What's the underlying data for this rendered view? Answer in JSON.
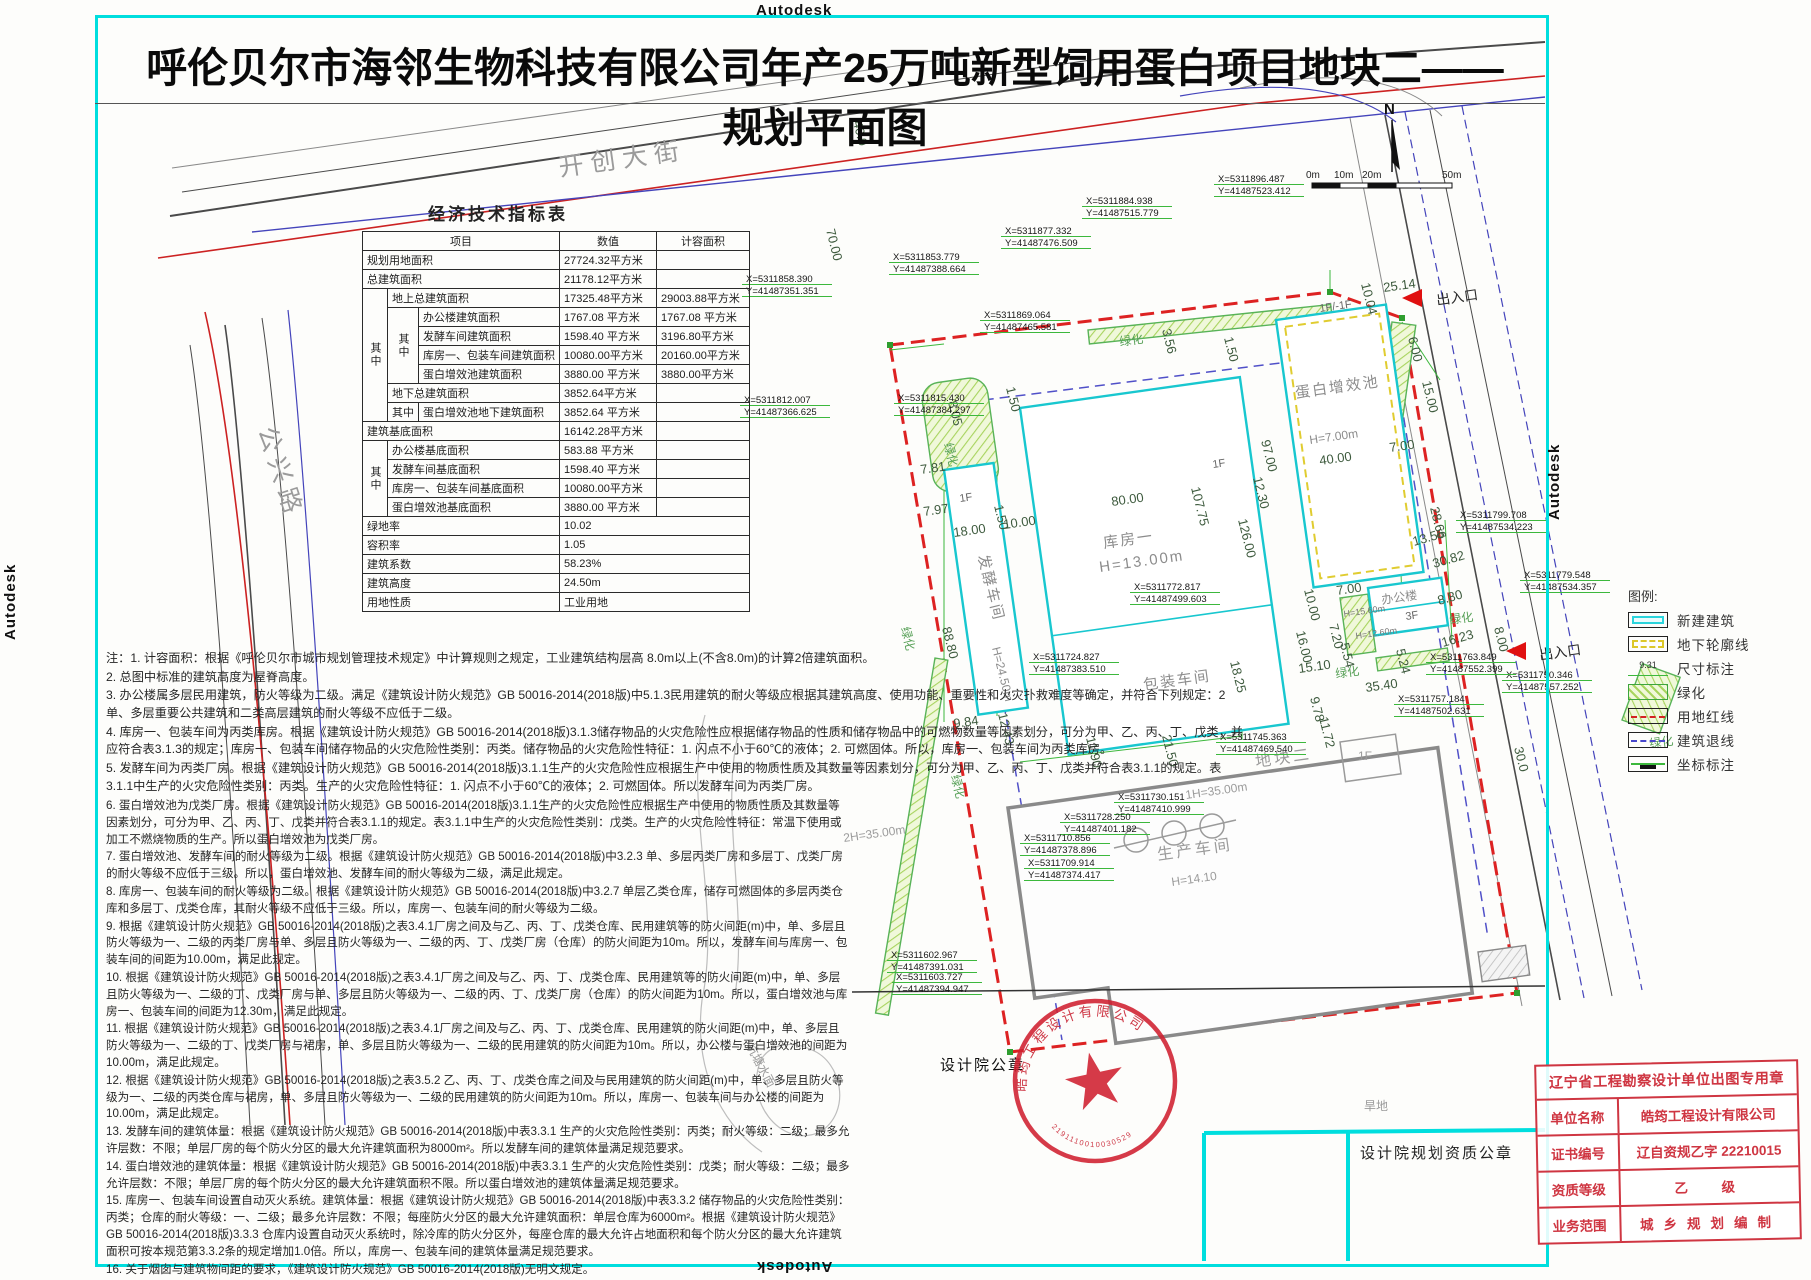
{
  "watermark": "Autodesk",
  "title": "呼伦贝尔市海邻生物科技有限公司年产25万吨新型饲用蛋白项目地块二——规划平面图",
  "table": {
    "title": "经济技术指标表",
    "col_item": "项目",
    "col_value": "数值",
    "col_capacity": "计容面积",
    "zhong": "其中",
    "rows": {
      "ra": {
        "l": "规划用地面积",
        "v": "27724.32平方米"
      },
      "rb": {
        "l": "总建筑面积",
        "v": "21178.12平方米"
      },
      "rc": {
        "l": "地上总建筑面积",
        "v": "17325.48平方米",
        "c": "29003.88平方米"
      },
      "rd": {
        "l": "办公楼建筑面积",
        "v": "1767.08 平方米",
        "c": "1767.08 平方米"
      },
      "re": {
        "l": "发酵车间建筑面积",
        "v": "1598.40 平方米",
        "c": "3196.80平方米"
      },
      "rf": {
        "l": "库房一、包装车间建筑面积",
        "v": "10080.00平方米",
        "c": "20160.00平方米"
      },
      "rg": {
        "l": "蛋白增效池建筑面积",
        "v": "3880.00 平方米",
        "c": "3880.00平方米"
      },
      "rh": {
        "l": "地下总建筑面积",
        "v": "3852.64平方米"
      },
      "ri": {
        "l": "蛋白增效池地下建筑面积",
        "v": "3852.64 平方米"
      },
      "rj": {
        "l": "建筑基底面积",
        "v": "16142.28平方米"
      },
      "rk": {
        "l": "办公楼基底面积",
        "v": "583.88  平方米"
      },
      "rl": {
        "l": "发酵车间基底面积",
        "v": "1598.40 平方米"
      },
      "rm": {
        "l": "库房一、包装车间基底面积",
        "v": "10080.00平方米"
      },
      "rn": {
        "l": "蛋白增效池基底面积",
        "v": "3880.00 平方米"
      },
      "ro": {
        "l": "绿地率",
        "v": "10.02"
      },
      "rp": {
        "l": "容积率",
        "v": "1.05"
      },
      "rq": {
        "l": "建筑系数",
        "v": "58.23%"
      },
      "rr": {
        "l": "建筑高度",
        "v": "24.50m"
      },
      "rs": {
        "l": "用地性质",
        "v": "工业用地"
      }
    }
  },
  "notes": [
    "注：1. 计容面积：根据《呼伦贝尔市城市规划管理技术规定》中计算规则之规定，工业建筑结构层高 8.0m以上(不含8.0m)的计算2倍建筑面积。",
    "2. 总图中标准的建筑高度为屋脊高度。",
    "3. 办公楼属多层民用建筑，防火等级为二级。满足《建筑设计防火规范》GB 50016-2014(2018版)中5.1.3民用建筑的耐火等级应根据其建筑高度、使用功能、重要性和火灾扑救难度等确定，并符合下列规定：2 单、多层重要公共建筑和二类高层建筑的耐火等级不应低于二级。",
    "4. 库房一、包装车间为丙类库房。根据《建筑设计防火规范》GB 50016-2014(2018版)3.1.3储存物品的火灾危险性应根据储存物品的性质和储存物品中的可燃物数量等因素划分，可分为甲、乙、丙、丁、戊类，并应符合表3.1.3的规定；库房一、包装车间储存物品的火灾危险性类别：丙类。储存物品的火灾危险性特征：1. 闪点不小于60℃的液体；2. 可燃固体。所以，库房一、包装车间为丙类库房。",
    "5. 发酵车间为丙类厂房。根据《建筑设计防火规范》GB 50016-2014(2018版)3.1.1生产的火灾危险性应根据生产中使用的物质性质及其数量等因素划分，可分为甲、乙、丙、丁、戊类并符合表3.1.1的规定。表3.1.1中生产的火灾危险性类别：丙类。生产的火灾危险性特征：1. 闪点不小于60℃的液体；2. 可燃固体。所以发酵车间为丙类厂房。",
    "6. 蛋白增效池为戊类厂房。根据《建筑设计防火规范》GB 50016-2014(2018版)3.1.1生产的火灾危险性应根据生产中使用的物质性质及其数量等因素划分，可分为甲、乙、丙、丁、戊类并符合表3.1.1的规定。表3.1.1中生产的火灾危险性类别：戊类。生产的火灾危险性特征：常温下使用或加工不燃烧物质的生产。所以蛋白增效池为戊类厂房。",
    "7. 蛋白增效池、发酵车间的耐火等级为二级。根据《建筑设计防火规范》GB 50016-2014(2018版)中3.2.3 单、多层丙类厂房和多层丁、戊类厂房的耐火等级不应低于三级。所以，蛋白增效池、发酵车间的耐火等级为二级，满足此规定。",
    "8. 库房一、包装车间的耐火等级为二级。根据《建筑设计防火规范》GB 50016-2014(2018版)中3.2.7 单层乙类仓库，储存可燃固体的多层丙类仓库和多层丁、戊类仓库，其耐火等级不应低于三级。所以，库房一、包装车间的耐火等级为二级。",
    "9. 根据《建筑设计防火规范》GB 50016-2014(2018版)之表3.4.1厂房之间及与乙、丙、丁、戊类仓库、民用建筑等的防火间距(m)中，单、多层且防火等级为一、二级的丙类厂房与单、多层且防火等级为一、二级的丙、丁、戊类厂房（仓库）的防火间距为10m。所以，发酵车间与库房一、包装车间的间距为10.00m，满足此规定。",
    "10. 根据《建筑设计防火规范》GB 50016-2014(2018版)之表3.4.1厂房之间及与乙、丙、丁、戊类仓库、民用建筑等的防火间距(m)中，单、多层且防火等级为一、二级的丁、戊类厂房与单、多层且防火等级为一、二级的丙、丁、戊类厂房（仓库）的防火间距为10m。所以，蛋白增效池与库房一、包装车间的间距为12.30m，满足此规定。",
    "11. 根据《建筑设计防火规范》GB 50016-2014(2018版)之表3.4.1厂房之间及与乙、丙、丁、戊类仓库、民用建筑的防火间距(m)中，单、多层且防火等级为一、二级的丁、戊类厂房与裙房，单、多层且防火等级为一、二级的民用建筑的防火间距为10m。所以，办公楼与蛋白增效池的间距为10.00m，满足此规定。",
    "12. 根据《建筑设计防火规范》GB 50016-2014(2018版)之表3.5.2 乙、丙、丁、戊类仓库之间及与民用建筑的防火间距(m)中，单、多层且防火等级为一、二级的丙类仓库与裙房，单、多层且防火等级为一、二级的民用建筑的防火间距为10m。所以，库房一、包装车间与办公楼的间距为10.00m，满足此规定。",
    "13. 发酵车间的建筑体量：根据《建筑设计防火规范》GB 50016-2014(2018版)中表3.3.1 生产的火灾危险性类别：丙类；耐火等级：二级；最多允许层数：不限；单层厂房的每个防火分区的最大允许建筑面积为8000m²。所以发酵车间的建筑体量满足规范要求。",
    "14. 蛋白增效池的建筑体量：根据《建筑设计防火规范》GB 50016-2014(2018版)中表3.3.1 生产的火灾危险性类别：戊类；耐火等级：二级；最多允许层数：不限；单层厂房的每个防火分区的最大允许建筑面积不限。所以蛋白增效池的建筑体量满足规范要求。",
    "15. 库房一、包装车间设置自动灭火系统。建筑体量：根据《建筑设计防火规范》GB 50016-2014(2018版)中表3.3.2 储存物品的火灾危险性类别：丙类；仓库的耐火等级：一、二级；最多允许层数：不限；每座防火分区的最大允许建筑面积：单层仓库为6000m²。根据《建筑设计防火规范》GB 50016-2014(2018版)3.3.3 仓库内设置自动灭火系统时，除冷库的防火分区外，每座仓库的最大允许占地面积和每个防火分区的最大允许建筑面积可按本规范第3.3.2条的规定增加1.0倍。所以，库房一、包装车间的建筑体量满足规范要求。",
    "16. 关于烟囱与建筑物间距的要求，《建筑设计防火规范》GB 50016-2014(2018版)无明文规定。"
  ],
  "legend": {
    "title": "图例:",
    "dim_sample": "9.31",
    "items": [
      {
        "label": "新建建筑"
      },
      {
        "label": "地下轮廓线"
      },
      {
        "label": "尺寸标注"
      },
      {
        "label": "绿化"
      },
      {
        "label": "用地红线"
      },
      {
        "label": "建筑退线"
      },
      {
        "label": "坐标标注"
      }
    ]
  },
  "stamps": {
    "seal_label": "设计院公章",
    "qual_label": "设计院规划资质公章",
    "round_company": "皓筠工程设计有限公司",
    "round_number": "2191110010030529",
    "cert": {
      "title": "辽宁省工程勘察设计单位出图专用章",
      "rows": [
        {
          "k": "单位名称",
          "v": "皓筠工程设计有限公司"
        },
        {
          "k": "证书编号",
          "v": "辽自资规乙字 22210015"
        },
        {
          "k": "资质等级",
          "v": "乙　级"
        },
        {
          "k": "业务范围",
          "v": "城乡规划编制"
        }
      ]
    }
  },
  "plan": {
    "texts": [
      {
        "t": "开创大街",
        "x": 560,
        "y": 176,
        "r": -8,
        "c": "road"
      },
      {
        "t": "公兴路",
        "x": 258,
        "y": 430,
        "r": 72,
        "c": "road"
      },
      {
        "t": "N",
        "x": 1384,
        "y": 114,
        "r": 0,
        "c": "north"
      },
      {
        "t": "0m",
        "x": 1306,
        "y": 178,
        "r": 0,
        "c": "tiny"
      },
      {
        "t": "10m",
        "x": 1334,
        "y": 178,
        "r": 0,
        "c": "tiny"
      },
      {
        "t": "20m",
        "x": 1362,
        "y": 178,
        "r": 0,
        "c": "tiny"
      },
      {
        "t": "50m",
        "x": 1442,
        "y": 178,
        "r": 0,
        "c": "tiny"
      },
      {
        "t": "出入口",
        "x": 1437,
        "y": 305,
        "r": -8,
        "c": "lbl"
      },
      {
        "t": "出入口",
        "x": 1540,
        "y": 660,
        "r": -8,
        "c": "lbl"
      },
      {
        "t": "发酵车间",
        "x": 978,
        "y": 556,
        "r": 76,
        "c": "bld"
      },
      {
        "t": "H=24.50m",
        "x": 992,
        "y": 648,
        "r": 76,
        "c": "bldsm"
      },
      {
        "t": "1F",
        "x": 960,
        "y": 502,
        "r": -8,
        "c": "small"
      },
      {
        "t": "库房一",
        "x": 1104,
        "y": 548,
        "r": -8,
        "c": "bld"
      },
      {
        "t": "H=13.00m",
        "x": 1100,
        "y": 572,
        "r": -8,
        "c": "bld"
      },
      {
        "t": "1F",
        "x": 1213,
        "y": 468,
        "r": -8,
        "c": "small"
      },
      {
        "t": "包装车间",
        "x": 1144,
        "y": 690,
        "r": -8,
        "c": "bld"
      },
      {
        "t": "蛋白增效池",
        "x": 1296,
        "y": 398,
        "r": -8,
        "c": "bld"
      },
      {
        "t": "H=7.00m",
        "x": 1310,
        "y": 444,
        "r": -8,
        "c": "bldsm"
      },
      {
        "t": "1F/-1F",
        "x": 1320,
        "y": 312,
        "r": -8,
        "c": "small"
      },
      {
        "t": "办公楼",
        "x": 1382,
        "y": 604,
        "r": -8,
        "c": "bldsm"
      },
      {
        "t": "3F",
        "x": 1406,
        "y": 620,
        "r": -8,
        "c": "small"
      },
      {
        "t": "H=15.60m",
        "x": 1344,
        "y": 617,
        "r": -8,
        "c": "tiny2"
      },
      {
        "t": "H=12.60m",
        "x": 1356,
        "y": 639,
        "r": -8,
        "c": "tiny2"
      },
      {
        "t": "生产车间",
        "x": 1158,
        "y": 860,
        "r": -8,
        "c": "grey-b"
      },
      {
        "t": "H=14.10",
        "x": 1172,
        "y": 886,
        "r": -8,
        "c": "grey"
      },
      {
        "t": "1F",
        "x": 1358,
        "y": 760,
        "r": 0,
        "c": "grey"
      },
      {
        "t": "1H=35.00m",
        "x": 1186,
        "y": 799,
        "r": -8,
        "c": "grey"
      },
      {
        "t": "2H=35.00m",
        "x": 844,
        "y": 842,
        "r": -8,
        "c": "grey"
      },
      {
        "t": "地块二",
        "x": 1256,
        "y": 767,
        "r": -8,
        "c": "grey-b"
      },
      {
        "t": "旱地",
        "x": 1364,
        "y": 1110,
        "r": 0,
        "c": "grey"
      },
      {
        "t": "坑塘水面",
        "x": 746,
        "y": 1046,
        "r": 62,
        "c": "grey"
      },
      {
        "t": "绿化",
        "x": 944,
        "y": 444,
        "r": 76,
        "c": "green"
      },
      {
        "t": "绿化",
        "x": 1120,
        "y": 346,
        "r": -8,
        "c": "green"
      },
      {
        "t": "绿化",
        "x": 901,
        "y": 628,
        "r": 76,
        "c": "green"
      },
      {
        "t": "绿化",
        "x": 951,
        "y": 776,
        "r": 76,
        "c": "green"
      },
      {
        "t": "绿化",
        "x": 1336,
        "y": 678,
        "r": -8,
        "c": "green"
      },
      {
        "t": "绿化",
        "x": 1450,
        "y": 624,
        "r": -8,
        "c": "green"
      },
      {
        "t": "绿化",
        "x": 1650,
        "y": 748,
        "r": -8,
        "c": "green"
      },
      {
        "t": "40.0",
        "x": 853,
        "y": 122,
        "r": 76,
        "c": "dim"
      },
      {
        "t": "70.00",
        "x": 826,
        "y": 230,
        "r": 76,
        "c": "dim"
      },
      {
        "t": "8.05",
        "x": 948,
        "y": 402,
        "r": 76,
        "c": "dim"
      },
      {
        "t": "7.81",
        "x": 921,
        "y": 474,
        "r": -8,
        "c": "dim"
      },
      {
        "t": "7.97",
        "x": 924,
        "y": 516,
        "r": -8,
        "c": "dim"
      },
      {
        "t": "1.50",
        "x": 994,
        "y": 506,
        "r": 76,
        "c": "dim"
      },
      {
        "t": "18.00",
        "x": 954,
        "y": 537,
        "r": -8,
        "c": "dim"
      },
      {
        "t": "10.00",
        "x": 1004,
        "y": 529,
        "r": -8,
        "c": "dim"
      },
      {
        "t": "1.50",
        "x": 1006,
        "y": 388,
        "r": 76,
        "c": "dim"
      },
      {
        "t": "3.56",
        "x": 1162,
        "y": 330,
        "r": 76,
        "c": "dim"
      },
      {
        "t": "1.50",
        "x": 1224,
        "y": 338,
        "r": 76,
        "c": "dim"
      },
      {
        "t": "88.80",
        "x": 942,
        "y": 628,
        "r": 76,
        "c": "dim"
      },
      {
        "t": "9.84",
        "x": 954,
        "y": 728,
        "r": -8,
        "c": "dim"
      },
      {
        "t": "12.43",
        "x": 998,
        "y": 714,
        "r": 76,
        "c": "dim"
      },
      {
        "t": "11.90",
        "x": 1086,
        "y": 738,
        "r": 76,
        "c": "dim"
      },
      {
        "t": "21.50",
        "x": 1162,
        "y": 736,
        "r": 76,
        "c": "dim"
      },
      {
        "t": "18.25",
        "x": 1230,
        "y": 662,
        "r": 76,
        "c": "dim"
      },
      {
        "t": "80.00",
        "x": 1112,
        "y": 506,
        "r": -8,
        "c": "dim"
      },
      {
        "t": "107.75",
        "x": 1191,
        "y": 488,
        "r": 76,
        "c": "dim"
      },
      {
        "t": "126.00",
        "x": 1238,
        "y": 520,
        "r": 76,
        "c": "dim"
      },
      {
        "t": "97.00",
        "x": 1261,
        "y": 441,
        "r": 76,
        "c": "dim"
      },
      {
        "t": "12.30",
        "x": 1253,
        "y": 478,
        "r": 76,
        "c": "dim"
      },
      {
        "t": "40.00",
        "x": 1320,
        "y": 465,
        "r": -8,
        "c": "dim"
      },
      {
        "t": "7.00",
        "x": 1390,
        "y": 452,
        "r": -8,
        "c": "dim"
      },
      {
        "t": "16.00",
        "x": 1296,
        "y": 632,
        "r": 76,
        "c": "dim"
      },
      {
        "t": "15.10",
        "x": 1299,
        "y": 673,
        "r": -8,
        "c": "dim"
      },
      {
        "t": "9.78",
        "x": 1310,
        "y": 698,
        "r": 76,
        "c": "dim"
      },
      {
        "t": "11.72",
        "x": 1319,
        "y": 718,
        "r": 76,
        "c": "dim"
      },
      {
        "t": "7.00",
        "x": 1337,
        "y": 595,
        "r": -8,
        "c": "dim"
      },
      {
        "t": "7.20",
        "x": 1329,
        "y": 625,
        "r": 76,
        "c": "dim"
      },
      {
        "t": "5.54",
        "x": 1340,
        "y": 644,
        "r": 76,
        "c": "dim"
      },
      {
        "t": "5.24",
        "x": 1396,
        "y": 650,
        "r": 76,
        "c": "dim"
      },
      {
        "t": "10.00",
        "x": 1304,
        "y": 590,
        "r": 76,
        "c": "dim"
      },
      {
        "t": "35.40",
        "x": 1366,
        "y": 692,
        "r": -8,
        "c": "dim"
      },
      {
        "t": "10.04",
        "x": 1361,
        "y": 284,
        "r": 76,
        "c": "dim"
      },
      {
        "t": "25.14",
        "x": 1384,
        "y": 292,
        "r": -8,
        "c": "dim"
      },
      {
        "t": "6.00",
        "x": 1408,
        "y": 338,
        "r": 76,
        "c": "dim"
      },
      {
        "t": "15.00",
        "x": 1422,
        "y": 382,
        "r": 76,
        "c": "dim"
      },
      {
        "t": "28.66",
        "x": 1430,
        "y": 508,
        "r": 76,
        "c": "dim"
      },
      {
        "t": "13.56",
        "x": 1414,
        "y": 546,
        "r": -16,
        "c": "dim"
      },
      {
        "t": "30.82",
        "x": 1434,
        "y": 568,
        "r": -16,
        "c": "dim"
      },
      {
        "t": "8.80",
        "x": 1439,
        "y": 605,
        "r": -16,
        "c": "dim"
      },
      {
        "t": "16.23",
        "x": 1443,
        "y": 647,
        "r": -16,
        "c": "dim"
      },
      {
        "t": "8.00",
        "x": 1494,
        "y": 628,
        "r": 76,
        "c": "dim"
      },
      {
        "t": "30.0",
        "x": 1514,
        "y": 748,
        "r": 76,
        "c": "dim"
      }
    ],
    "coords": [
      {
        "x": 746,
        "y": 282,
        "a": "X=5311858.390",
        "b": "Y=41487351.351"
      },
      {
        "x": 893,
        "y": 260,
        "a": "X=5311853.779",
        "b": "Y=41487388.664"
      },
      {
        "x": 1005,
        "y": 234,
        "a": "X=5311877.332",
        "b": "Y=41487476.509"
      },
      {
        "x": 1086,
        "y": 204,
        "a": "X=5311884.938",
        "b": "Y=41487515.779"
      },
      {
        "x": 1218,
        "y": 182,
        "a": "X=5311896.487",
        "b": "Y=41487523.412"
      },
      {
        "x": 984,
        "y": 318,
        "a": "X=5311869.064",
        "b": "Y=41487465.581"
      },
      {
        "x": 898,
        "y": 401,
        "a": "X=5311815.430",
        "b": "Y=41487384.297"
      },
      {
        "x": 744,
        "y": 403,
        "a": "X=5311812.007",
        "b": "Y=41487366.625"
      },
      {
        "x": 1460,
        "y": 518,
        "a": "X=5311799.708",
        "b": "Y=41487534.223"
      },
      {
        "x": 1524,
        "y": 578,
        "a": "X=5311779.548",
        "b": "Y=41487534.357"
      },
      {
        "x": 1134,
        "y": 590,
        "a": "X=5311772.817",
        "b": "Y=41487499.603"
      },
      {
        "x": 1506,
        "y": 678,
        "a": "X=5311750.346",
        "b": "Y=41487557.252"
      },
      {
        "x": 1430,
        "y": 660,
        "a": "X=5311763.849",
        "b": "Y=41487552.399"
      },
      {
        "x": 1398,
        "y": 702,
        "a": "X=5311757.184",
        "b": "Y=41487502.631"
      },
      {
        "x": 1220,
        "y": 740,
        "a": "X=5311745.363",
        "b": "Y=41487469.540"
      },
      {
        "x": 1118,
        "y": 800,
        "a": "X=5311730.151",
        "b": "Y=41487410.999"
      },
      {
        "x": 1064,
        "y": 820,
        "a": "X=5311728.250",
        "b": "Y=41487401.182"
      },
      {
        "x": 1024,
        "y": 841,
        "a": "X=5311710.856",
        "b": "Y=41487378.896"
      },
      {
        "x": 1028,
        "y": 866,
        "a": "X=5311709.914",
        "b": "Y=41487374.417"
      },
      {
        "x": 1033,
        "y": 660,
        "a": "X=5311724.827",
        "b": "Y=41487383.510"
      },
      {
        "x": 891,
        "y": 958,
        "a": "X=5311602.967",
        "b": "Y=41487391.031"
      },
      {
        "x": 896,
        "y": 980,
        "a": "X=5311603.727",
        "b": "Y=41487394.947"
      }
    ]
  }
}
